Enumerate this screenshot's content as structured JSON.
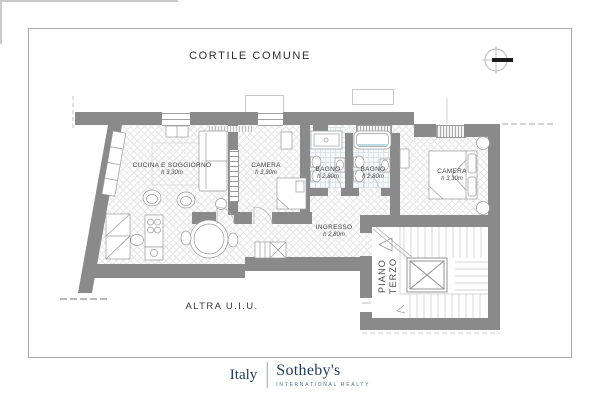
{
  "title": "CORTILE COMUNE",
  "plan": {
    "rooms": [
      {
        "name": "CUCINA E SOGGIORNO",
        "height": "h 3,30m"
      },
      {
        "name": "CAMERA",
        "height": "h 3,30m"
      },
      {
        "name": "BAGNO",
        "height": "h 2,80m"
      },
      {
        "name": "BAGNO",
        "height": "h 2,80m"
      },
      {
        "name": "CAMERA",
        "height": "h 3,30m"
      },
      {
        "name": "INGRESSO",
        "height": "h 2,80m"
      }
    ],
    "stairwell_label": {
      "line1": "PIANO",
      "line2": "TERZO"
    },
    "outside_label": "ALTRA U.I.U."
  },
  "compass": {
    "icon": "compass-icon"
  },
  "footer": {
    "brand_country": "Italy",
    "brand_name": "Sotheby's",
    "brand_tagline": "INTERNATIONAL REALTY"
  },
  "colors": {
    "wall_gray": "#8a8a8a",
    "brand_navy": "#1d3b5e",
    "tagline_gray": "#5b6c7e",
    "bath_tile": "#dde4e8"
  }
}
